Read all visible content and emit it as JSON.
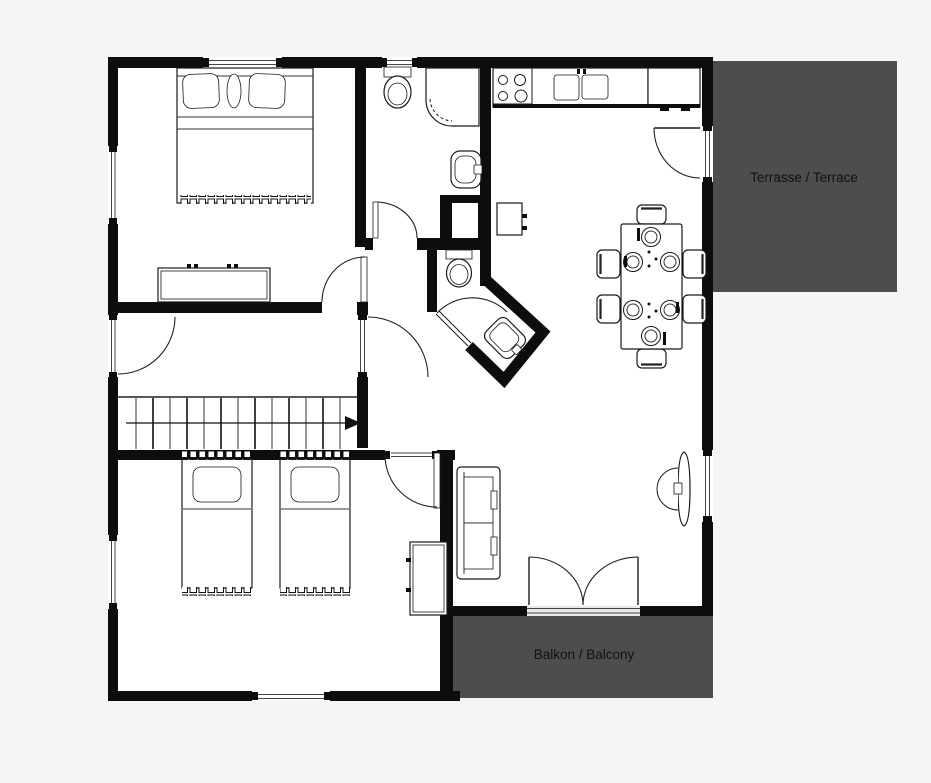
{
  "page": {
    "background": "#f5f5f5"
  },
  "plan": {
    "areas": {
      "terrace": {
        "label": "Terrasse / Terrace",
        "fill": "#4d4d4d"
      },
      "balcony": {
        "label": "Balkon / Balcony",
        "fill": "#4d4d4d"
      }
    },
    "colors": {
      "wall": "#0d0d0d",
      "floor": "#ffffff",
      "outline": "#1a1a1a",
      "label_text": "#111111"
    }
  }
}
